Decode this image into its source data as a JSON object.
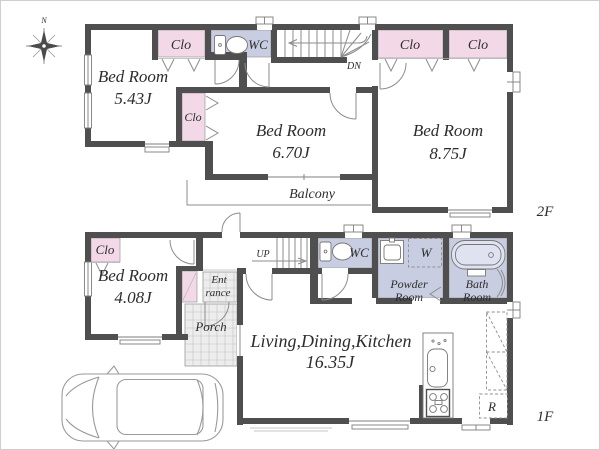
{
  "colors": {
    "wall": "#4f4f4f",
    "closet_fill": "#f3d9e8",
    "wet_area_fill": "#c9cde2",
    "tile_fill": "#ededed",
    "line": "#8c8c8c",
    "text": "#2d2d2d",
    "background": "#ffffff"
  },
  "compass": {
    "north": "N"
  },
  "floor2": {
    "label": "2F",
    "bedroom_small": {
      "name": "Bed Room",
      "area": "5.43J"
    },
    "bedroom_mid": {
      "name": "Bed Room",
      "area": "6.70J"
    },
    "bedroom_large": {
      "name": "Bed Room",
      "area": "8.75J"
    },
    "closet1": "Clo",
    "closet2": "Clo",
    "closet3": "Clo",
    "closet4": "Clo",
    "wc": "WC",
    "stairs_dn": "DN",
    "balcony": "Balcony"
  },
  "floor1": {
    "label": "1F",
    "bedroom": {
      "name": "Bed Room",
      "area": "4.08J"
    },
    "closet": "Clo",
    "entrance_line1": "Ent",
    "entrance_line2": "rance",
    "porch": "Porch",
    "stairs_up": "UP",
    "wc": "WC",
    "powder_line1": "Powder",
    "powder_line2": "Room",
    "washer": "W",
    "bath_line1": "Bath",
    "bath_line2": "Room",
    "ldk": {
      "name": "Living,Dining,Kitchen",
      "area": "16.35J"
    },
    "refrigerator": "R"
  }
}
